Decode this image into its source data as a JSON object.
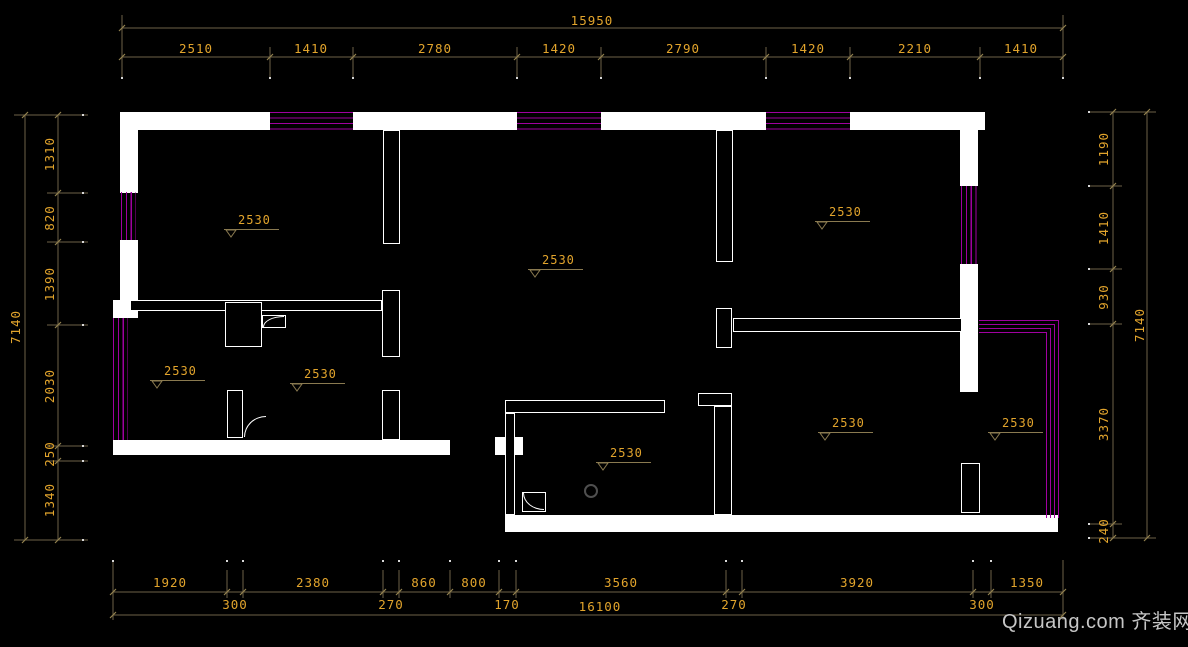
{
  "colors": {
    "background": "#000000",
    "wall": "#ffffff",
    "window_hatch": "#a000a0",
    "dimension_line": "#6e6248",
    "dimension_text": "#e2a42c",
    "watermark": "#c6c6c6"
  },
  "dimensions": {
    "top": {
      "overall": "15950",
      "segments": [
        "2510",
        "1410",
        "2780",
        "1420",
        "2790",
        "1420",
        "2210",
        "1410"
      ]
    },
    "left": {
      "overall": "7140",
      "segments": [
        "1310",
        "820",
        "1390",
        "2030",
        "250",
        "1340"
      ]
    },
    "right": {
      "overall": "7140",
      "segments": [
        "1190",
        "1410",
        "930",
        "3370",
        "240"
      ]
    },
    "bottom": {
      "overall": "16100",
      "segments_major": [
        "1920",
        "2380",
        "860",
        "800",
        "3560",
        "3920",
        "1350"
      ],
      "segments_minor": [
        "300",
        "270",
        "170",
        "270",
        "300"
      ]
    }
  },
  "levels": {
    "value": "2530",
    "count": 8
  },
  "watermark": {
    "text": "Qizuang.com 齐装网"
  }
}
